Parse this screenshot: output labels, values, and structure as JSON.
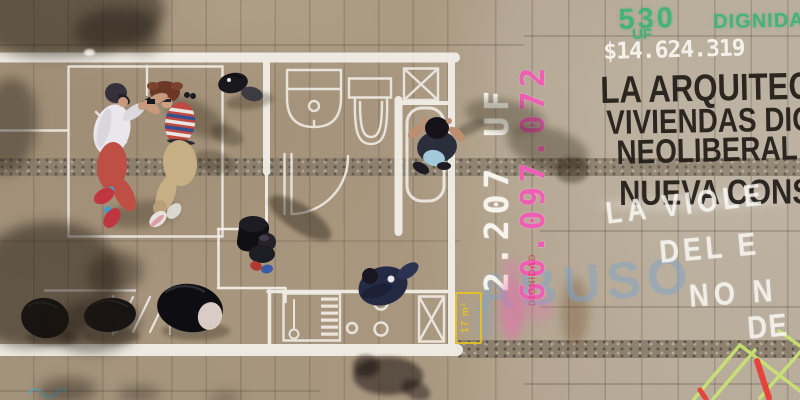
{
  "scene": {
    "caption": "Aerial drone view of a 17 m2 apartment floor plan drawn in white chalk on plaza paving, with people lying inside it, backpacks, and protest graffiti about housing prices"
  },
  "graffiti": {
    "uf_price": "530",
    "uf_unit": "UF",
    "dignidad_green": "DIGNIDAD",
    "peso_price": "$14.624.319",
    "mural_line_1": "LA ARQUITEC",
    "mural_line_2": "VIVIENDAS DIG",
    "mural_line_3": "NEOLIBERAL",
    "mural_line_4": "NUEVA CONS",
    "chalk_line_1": "LA VIOLE",
    "chalk_line_2": "DEL E",
    "chalk_line_3": "NO N",
    "chalk_line_4": "DE",
    "abuso": "ABUSO",
    "vertical_uf_price": "2.207 UF",
    "vertical_peso_price": "60.097.072",
    "vertical_dignidad_red": "DIGNIDAD",
    "area_label": "17 m²"
  },
  "colors": {
    "spray_green": "#3eb377",
    "chalk_pink": "#ee5fb4",
    "chalk_white": "#f6f3ea",
    "paint_black": "#26201b",
    "chalk_blue": "#80a4c8",
    "marker_yellow": "#e5c225",
    "sketch_green": "#c9e472",
    "accent_red": "#e5433b"
  }
}
